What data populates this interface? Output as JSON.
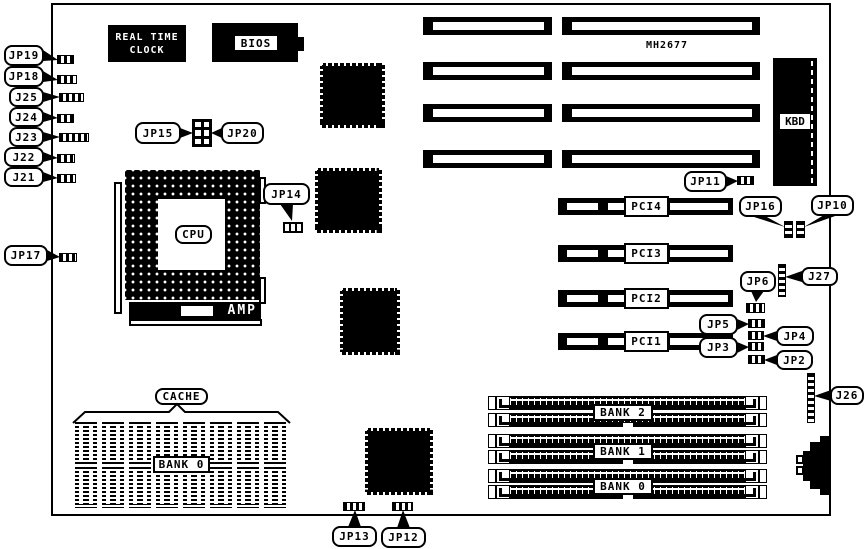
{
  "board": {
    "model_text": "MH2677"
  },
  "components": {
    "rtc_line1": "REAL TIME",
    "rtc_line2": "CLOCK",
    "bios": "BIOS",
    "cpu": "CPU",
    "amp": "AMP",
    "kbd": "KBD",
    "cache_label": "CACHE",
    "cache_bank": "BANK 0"
  },
  "pci_slots": [
    "PCI4",
    "PCI3",
    "PCI2",
    "PCI1"
  ],
  "memory_banks": [
    "BANK 2",
    "BANK 1",
    "BANK 0"
  ],
  "callouts": {
    "jp19": "JP19",
    "jp18": "JP18",
    "j25": "J25",
    "j24": "J24",
    "j23": "J23",
    "j22": "J22",
    "j21": "J21",
    "jp17": "JP17",
    "jp15": "JP15",
    "jp20": "JP20",
    "jp14": "JP14",
    "jp11": "JP11",
    "jp16": "JP16",
    "jp10": "JP10",
    "j27": "J27",
    "jp6": "JP6",
    "jp5": "JP5",
    "jp4": "JP4",
    "jp3": "JP3",
    "jp2": "JP2",
    "j26": "J26",
    "jp13": "JP13",
    "jp12": "JP12"
  }
}
